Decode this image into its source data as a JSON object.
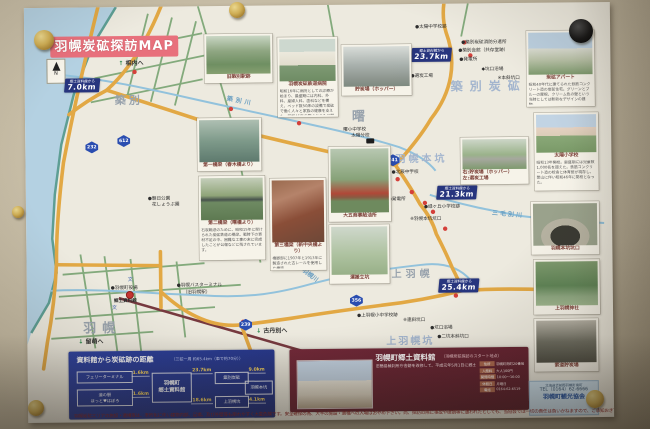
{
  "poster": {
    "title": "羽幌炭砿探訪MAP",
    "compass": "N",
    "warning": "羽幌炭砿エリアの施設・遺構等は、老朽化に伴い建物内部、足場、及び外壁等も崩れやすく大変危険です。安全確保の為、大半の施設・遺構への入場はおやめ下さい。尚、探訪の際に事故や破損等に遭われたとしても、当協会では一切の責任は負いかねますので、ご承知おき下さい。"
  },
  "areas": {
    "chikubetsu": "築別",
    "akebono": "曙",
    "haboro": "羽幌",
    "kamihaboro": "上羽幌",
    "chikubetsu_tanko": "築別炭砿",
    "haboro_honko": "羽幌本坑",
    "kamihaboro_ko": "上羽幌坑"
  },
  "rivers": {
    "chikubetsu_river": "築別川",
    "sankebetsu_river": "三毛別川",
    "haboro_river": "羽幌川"
  },
  "directions": {
    "aiuchi": "相内へ",
    "kotanbetsu": "古丹別へ",
    "rumoi": "留萌へ",
    "up_arrow": "↑",
    "down_arrow": "↓"
  },
  "shields": {
    "r232": "232",
    "r612": "612",
    "r741": "741",
    "r356": "356",
    "r239": "239"
  },
  "badges": {
    "prefix": "郷土資料館から",
    "b1": "7.0km",
    "b2": "23.7km",
    "b3": "18.0km",
    "b4": "21.3km",
    "b5": "25.4km"
  },
  "pois": {
    "taiyo_jhs": "●太陽中学校跡",
    "fire": "●築別炭砿消防分遣所",
    "kaikan": "●築別会館（共存堂跡）",
    "power1": "●発電所",
    "bath1": "◆坑口浴場",
    "honshakou": "※本斜坑口",
    "sentan": "●選炭工場",
    "akebono_school1": "曙小中学校",
    "akebono_school2": "太陽分校",
    "hokushin": "●北辰中学校",
    "power2": "●発電所",
    "midorigaoka": "●緑ヶ丘小学校跡",
    "honko_kuchi": "※羽幌本坑坑口",
    "asahi1": "●朝日公園",
    "asahi2": "花しょうぶ園",
    "yakuba": "●羽幌町役場",
    "bus1": "●羽幌バスターミナル",
    "bus2": "（旧羽幌駅）",
    "museum": "郷土資料館",
    "kami_school": "●上羽幌小中学校跡",
    "rensha": "※連斜坑口",
    "bath2": "●坑口浴場",
    "nikou": "●二坑本斜坑口",
    "school_mark": "文"
  },
  "photos": {
    "station": {
      "caption": "旧築別駅跡"
    },
    "hospital": {
      "caption": "羽幌炭砿鉄道病院",
      "desc": "昭和16年に病院としての診療が始まり、最盛期には内科、外科、産婦人科、歯科などを備え、ベッド数50床の設備で炭砿で働く人々と家族の健康を支えた。昭和45年の閉山とともに閉院。"
    },
    "hopper": {
      "caption": "貯炭場（ホッパー）"
    },
    "apart": {
      "caption": "炭砿アパート",
      "desc": "昭和40年代に建てられた鉄筋コンクリート造の炭砿住宅。グリーンとブルーの屋根、クリーム色の壁という当時としては斬新なデザインの建物。"
    },
    "taiyo_es": {
      "caption": "太陽小学校",
      "desc": "昭和13年開校。最盛期には児童数1,000名を超えた。鉄筋コンクリート造の校舎と体育館が現存し、閉山に伴い昭和46年に閉校となった。"
    },
    "honko_kuchi": {
      "caption": "羽幌本坑坑口"
    },
    "jinja": {
      "caption": "上羽幌神社"
    },
    "sakudo": {
      "caption": "索道貯炭場"
    },
    "b1": {
      "caption": "第一橋梁（春木橋より）"
    },
    "b2": {
      "caption": "第二橋梁（曙橋より）",
      "desc": "石炭輸送のために、昭和15年に架けられた炭砿鉄道の橋梁。戦時下の資材不足の中、困難な工事の末に完成したことが公報などに残されています。"
    },
    "b3": {
      "caption": "第三橋梁（新中央橋より）",
      "desc": "橋脚部に1907年と1913年に製造された古レールを使用した橋梁。"
    },
    "gas": {
      "caption": "大五商事給油所"
    },
    "pair": {
      "caption1": "右:貯炭場（ホッパー）",
      "caption2": "左:選炭工場"
    },
    "tate": {
      "caption": "運搬立坑"
    },
    "museum_photo": {
      "caption": ""
    }
  },
  "distance_box": {
    "title": "資料館から炭砿跡の距離",
    "subtitle": "（三砿一周 約65.4km（車で約70分））",
    "ferry": "フェリーターミナル",
    "michinoeki1": "道の駅",
    "michinoeki2": "ほっと♥はぼろ",
    "museum1": "羽幌町",
    "museum2": "郷土資料館",
    "chikubetsu": "築別炭砿",
    "kamihaboro": "上羽幌坑",
    "honko": "羽幌本坑",
    "d_ferry": "1.6km",
    "d_michi": "1.6km",
    "d_chiku": "23.7km",
    "d_kami": "18.6km",
    "d_honko_top": "9.0km",
    "d_honko_bottom": "4.1km"
  },
  "museum_box": {
    "title": "羽幌町郷土資料館",
    "subtitle": "（羽幌炭砿探訪のスタート地点）",
    "desc": "旧簡易裁判所庁舎跡を改修して、平成元年5月1日に郷土資料館として開館しました。炭砿時代などの面影を伝える多くの資料、町内で発掘された貴重なアンモナイトなどの化石類や開拓期、ニシン漁などの資料1,700点余りが展示されています。炭砿の貴重な映像や写真も多く、ここで羽幌炭砿の知識を得て「羽幌炭砿探訪」のスタートとして下さい。",
    "i1l": "住所",
    "i1v": "羽幌町南町20番地",
    "i2l": "入館料",
    "i2v": "大人100円",
    "i3l": "開館時間",
    "i3v": "10:00〜16:00",
    "i4l": "休館日",
    "i4v": "月曜日",
    "i5l": "電話",
    "i5v": "0164-62-6519"
  },
  "tourism_box": {
    "address": "北海道苫前郡羽幌町南町",
    "tel": "TEL（0164）62-6666",
    "name": "羽幌町観光協会"
  }
}
